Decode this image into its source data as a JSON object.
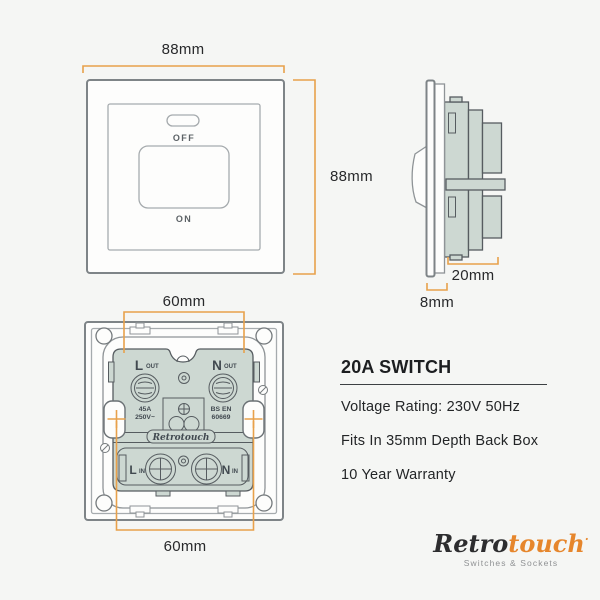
{
  "colors": {
    "background": "#f5f6f4",
    "dimension_orange": "#e8a14b",
    "mechanism_green": "#cdd8d2",
    "outline_gray": "#7e8487",
    "text_dark": "#28292b",
    "logo_orange": "#e6862c"
  },
  "front_view": {
    "width_label": "88mm",
    "height_label": "88mm",
    "off_label": "OFF",
    "on_label": "ON"
  },
  "side_view": {
    "depth_label": "20mm",
    "plate_label": "8mm"
  },
  "back_view": {
    "top_width_label": "60mm",
    "bottom_width_label": "60mm",
    "l_out_main": "L",
    "l_out_sub": "OUT",
    "n_out_main": "N",
    "n_out_sub": "OUT",
    "l_in_main": "L",
    "l_in_sub": "IN",
    "n_in_main": "N",
    "n_in_sub": "IN",
    "rating_line1": "45A",
    "rating_line2": "250V~",
    "standard_line1": "BS EN",
    "standard_line2": "60669",
    "brand_stamp": "Retrotouch"
  },
  "specs": {
    "title": "20A SWITCH",
    "items": [
      "Voltage Rating: 230V 50Hz",
      "Fits In 35mm Depth Back Box",
      "10 Year Warranty"
    ]
  },
  "logo": {
    "part1": "Retro",
    "part2": "touch",
    "mark": "·",
    "tagline": "Switches & Sockets"
  }
}
